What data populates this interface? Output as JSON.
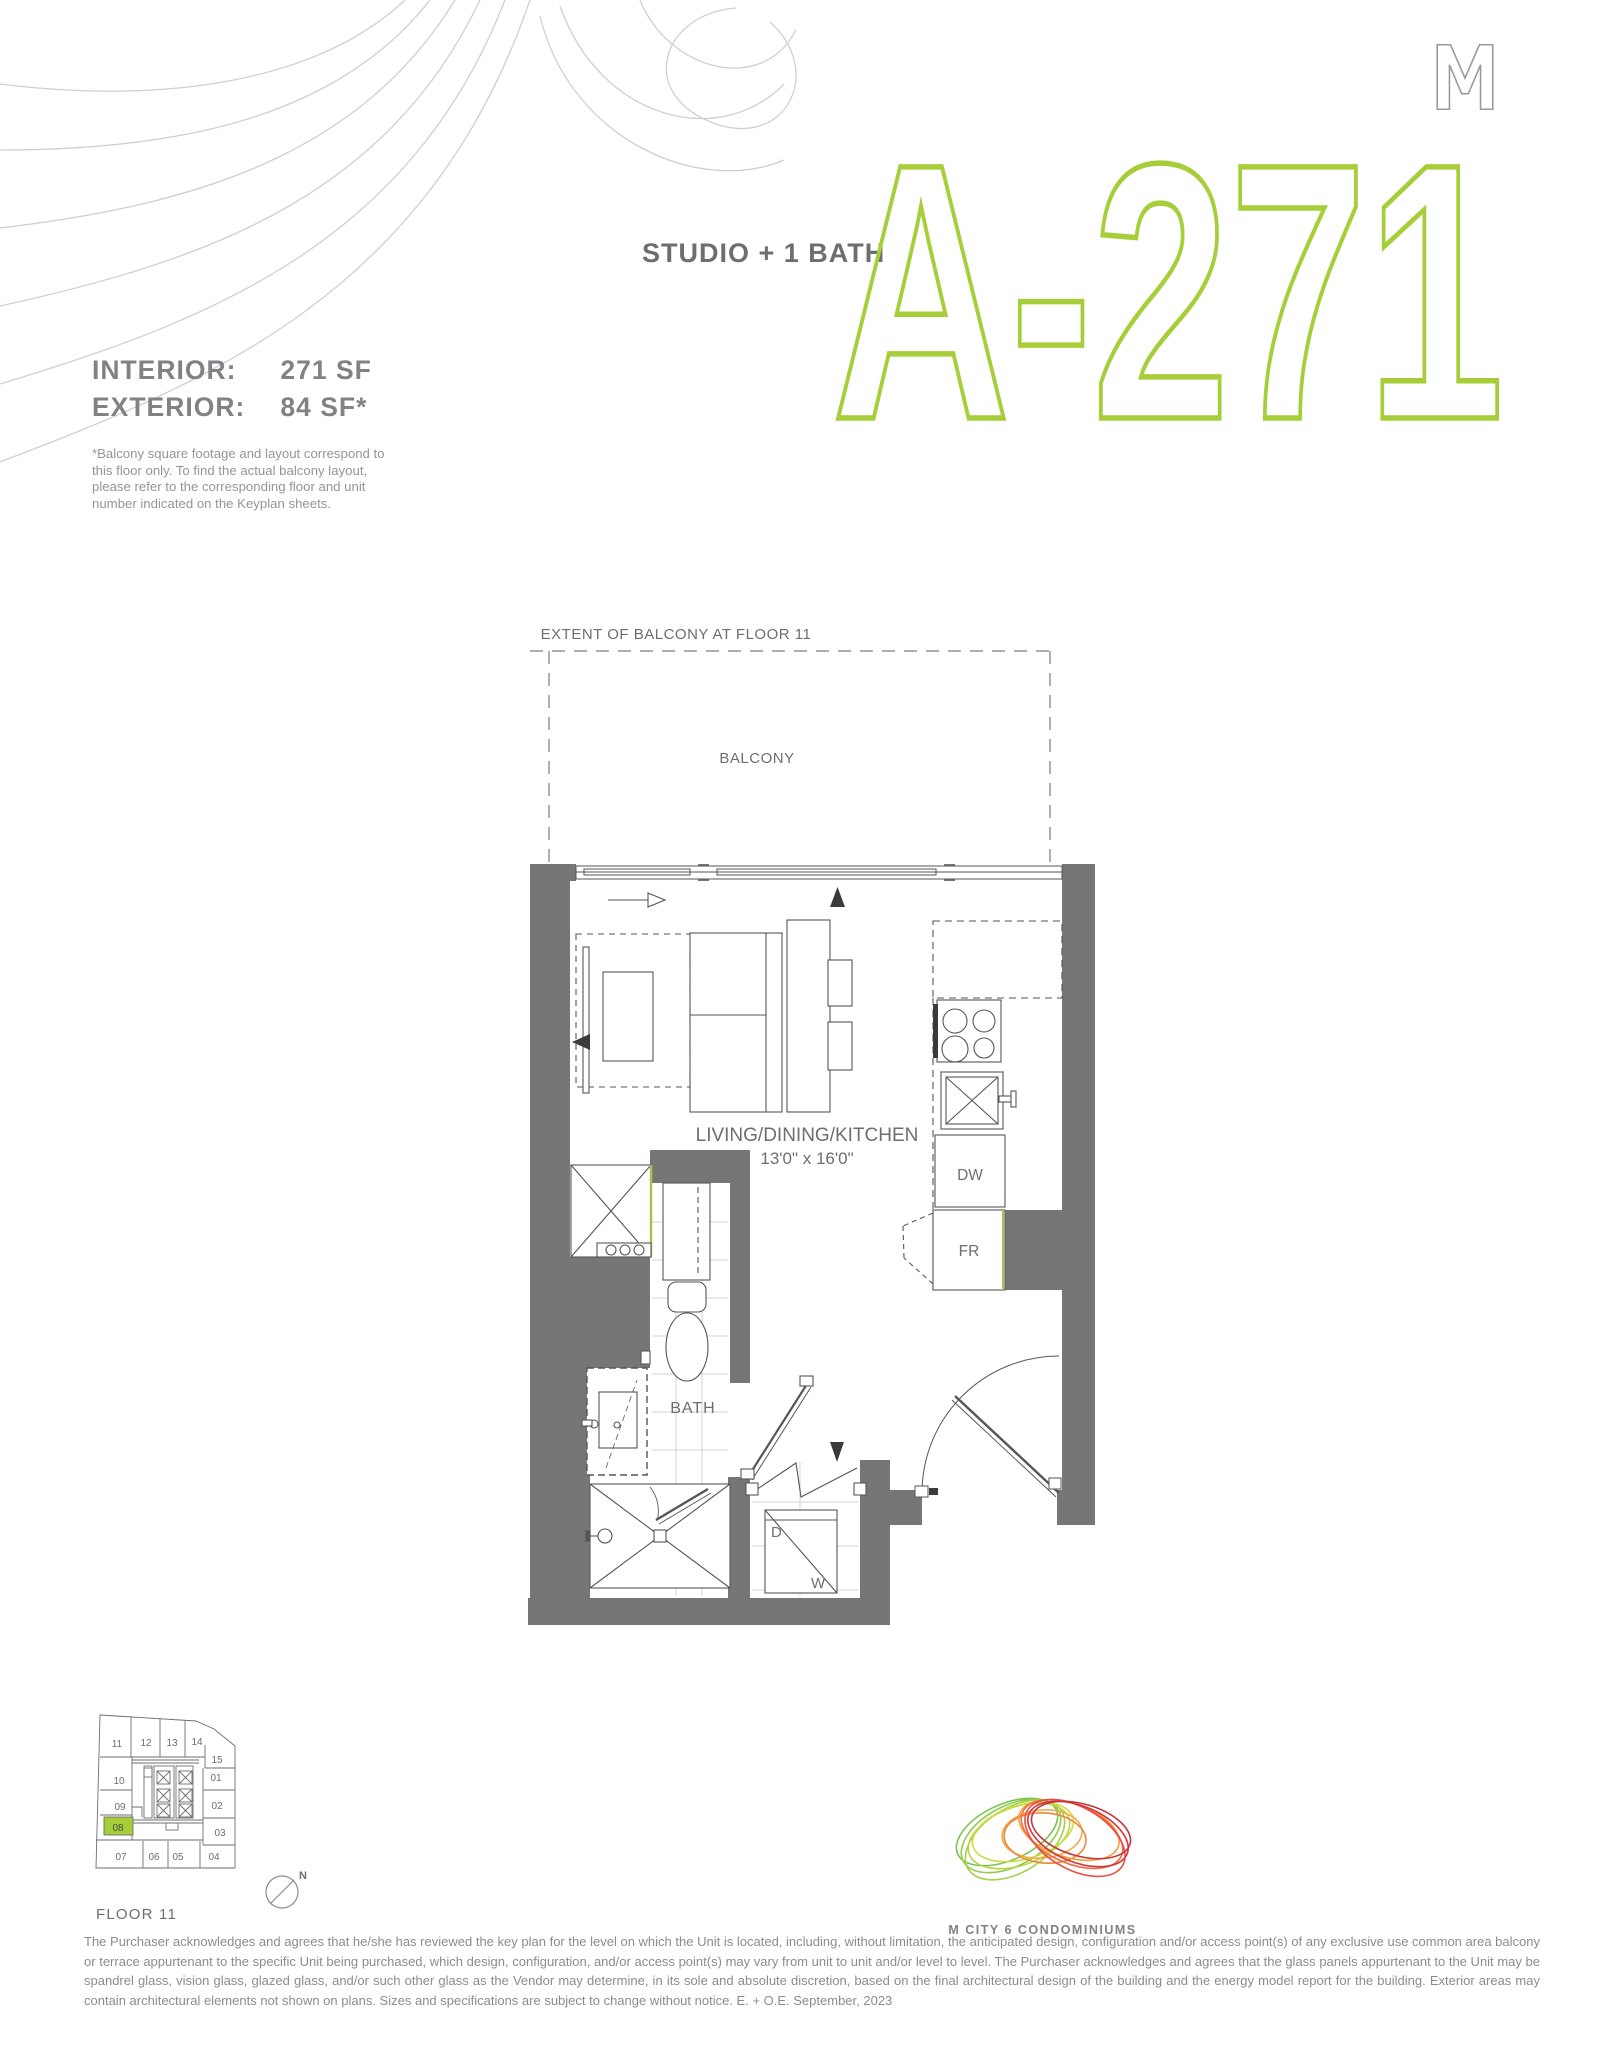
{
  "header": {
    "unit_type": "STUDIO + 1 BATH",
    "unit_code": "A-271",
    "interior_label": "INTERIOR:",
    "interior_value": "271 SF",
    "exterior_label": "EXTERIOR:",
    "exterior_value": "84 SF*",
    "balcony_note": "*Balcony square footage and layout correspond to this floor only. To find the actual balcony layout, please refer to the corresponding floor and unit number indicated on the Keyplan sheets."
  },
  "floorplan": {
    "extent_label": "EXTENT OF BALCONY AT FLOOR 11",
    "balcony_label": "BALCONY",
    "room_label": "LIVING/DINING/KITCHEN",
    "room_dims": "13'0\" x 16'0\"",
    "bath_label": "BATH",
    "dw_label": "DW",
    "fr_label": "FR",
    "dryer_label": "D",
    "washer_label": "W"
  },
  "keyplan": {
    "floor_label": "FLOOR 11",
    "north_label": "N",
    "highlighted_unit": "08",
    "units": [
      "11",
      "12",
      "13",
      "14",
      "15",
      "10",
      "01",
      "09",
      "02",
      "08",
      "03",
      "07",
      "06",
      "05",
      "04"
    ]
  },
  "brand": {
    "name": "M CITY 6 CONDOMINIUMS"
  },
  "footer": {
    "disclaimer": "The Purchaser acknowledges and agrees that he/she has reviewed the key plan for the level on which the Unit is located, including, without limitation, the anticipated design, configuration and/or access point(s) of any exclusive use common area balcony or terrace appurtenant to the specific Unit being purchased, which design, configuration, and/or access point(s) may vary from unit to unit and/or level to level. The Purchaser acknowledges and agrees that the glass panels appurtenant to the Unit may be spandrel glass, vision glass, glazed glass, and/or such other glass as the Vendor may determine, in its sole and absolute discretion, based on the final architectural design of the building and the energy model report for the building. Exterior areas may contain architectural elements not shown on plans. Sizes and specifications are subject to change without notice. E. + O.E. September, 2023"
  },
  "colors": {
    "accent_green": "#a6ce39",
    "wall_gray": "#767676",
    "text_gray": "#808285",
    "line_gray": "#55565a"
  }
}
